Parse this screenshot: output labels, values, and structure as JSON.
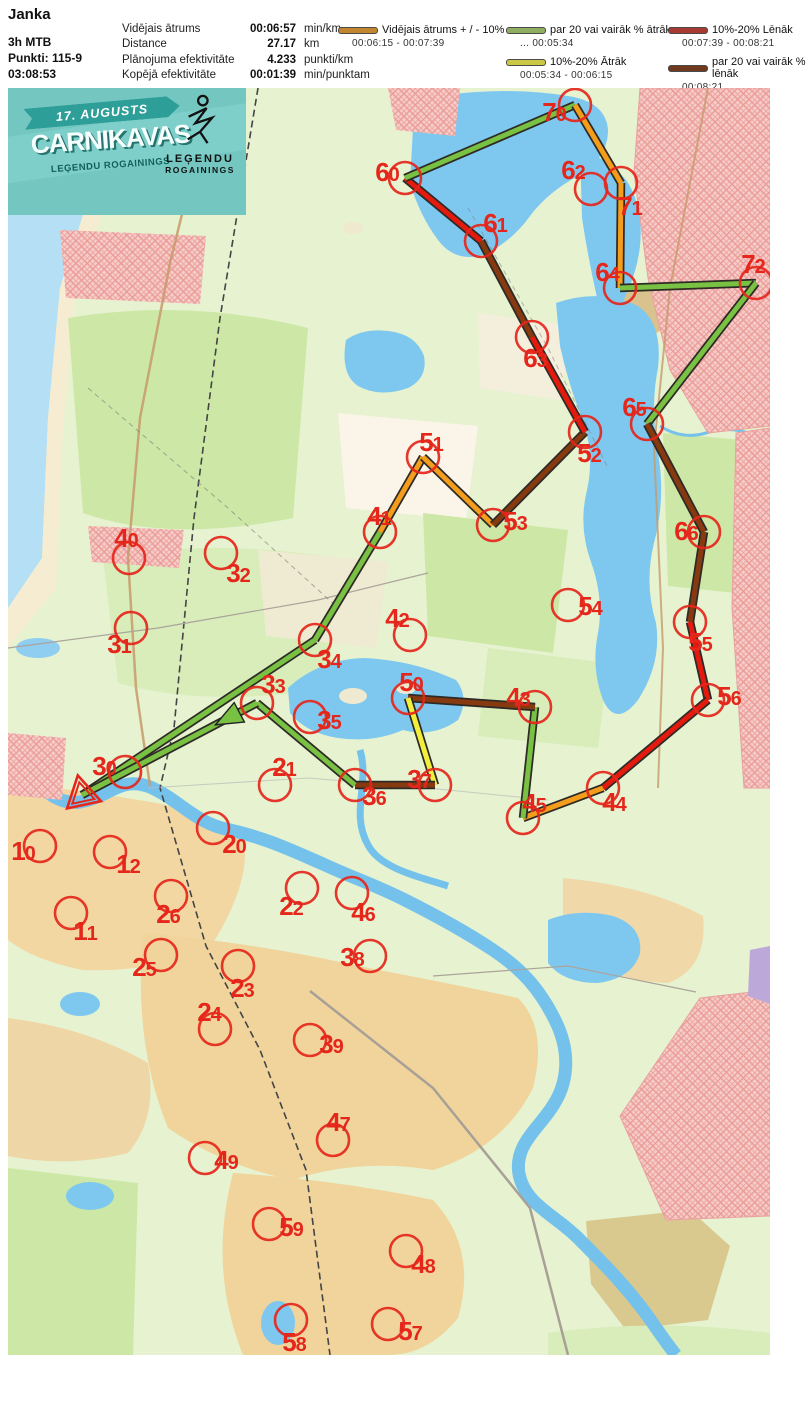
{
  "header": {
    "title": "Janka",
    "class_name": "3h MTB",
    "points": "Punkti: 115-9",
    "total_time": "03:08:53",
    "stats": [
      {
        "label": "Vidējais ātrums",
        "value": "00:06:57",
        "unit": "min/km"
      },
      {
        "label": "Distance",
        "value": "27.17",
        "unit": "km"
      },
      {
        "label": "Plānojuma efektivitāte",
        "value": "4.233",
        "unit": "punkti/km"
      },
      {
        "label": "Kopējā efektivitāte",
        "value": "00:01:39",
        "unit": "min/punktam"
      }
    ]
  },
  "legend": {
    "items": [
      {
        "col": 1,
        "color": "#c2862e",
        "label": "Vidējais ātrums + / - 10%",
        "range": "00:06:15   -   00:07:39"
      },
      {
        "col": 2,
        "color": "#8fae62",
        "label": "par 20 vai vairāk % ātrāk",
        "range": "...   00:05:34"
      },
      {
        "col": 2,
        "color": "#cbc943",
        "label": "10%-20% Ātrāk",
        "range": "00:05:34   -   00:06:15"
      },
      {
        "col": 3,
        "color": "#a93a31",
        "label": "10%-20% Lēnāk",
        "range": "00:07:39   -   00:08:21"
      },
      {
        "col": 3,
        "color": "#71391d",
        "label": "par 20 vai vairāk % lēnāk",
        "range": "00:08:21   ..."
      }
    ]
  },
  "banner": {
    "date": "17. AUGUSTS",
    "title": "CARNIKAVAS",
    "subtitle": "LEĢENDU ROGAININGS",
    "logo_line1": "LEĢENDU",
    "logo_line2": "ROGAININGS"
  },
  "map": {
    "control_color": "#e5261b",
    "route_outline": "#2e2a26",
    "route_colors": {
      "fast20": "#79c143",
      "fast10": "#f2ee3c",
      "average": "#f49d1c",
      "slow10": "#e41a0f",
      "slow20": "#87390f"
    },
    "start": {
      "x": 82,
      "y": 795
    },
    "controls": [
      {
        "id": "10",
        "x": 40,
        "y": 846,
        "lx": 23,
        "ly": 851
      },
      {
        "id": "11",
        "x": 71,
        "y": 913,
        "lx": 85,
        "ly": 931
      },
      {
        "id": "12",
        "x": 110,
        "y": 852,
        "lx": 128,
        "ly": 864
      },
      {
        "id": "20",
        "x": 213,
        "y": 828,
        "lx": 234,
        "ly": 844
      },
      {
        "id": "21",
        "x": 275,
        "y": 785,
        "lx": 284,
        "ly": 767
      },
      {
        "id": "22",
        "x": 302,
        "y": 888,
        "lx": 291,
        "ly": 906
      },
      {
        "id": "23",
        "x": 238,
        "y": 966,
        "lx": 242,
        "ly": 988
      },
      {
        "id": "24",
        "x": 215,
        "y": 1029,
        "lx": 209,
        "ly": 1012
      },
      {
        "id": "25",
        "x": 161,
        "y": 955,
        "lx": 144,
        "ly": 967
      },
      {
        "id": "26",
        "x": 171,
        "y": 896,
        "lx": 168,
        "ly": 914
      },
      {
        "id": "30",
        "x": 125,
        "y": 772,
        "lx": 104,
        "ly": 766
      },
      {
        "id": "31",
        "x": 131,
        "y": 628,
        "lx": 119,
        "ly": 644
      },
      {
        "id": "32",
        "x": 221,
        "y": 553,
        "lx": 238,
        "ly": 573
      },
      {
        "id": "33",
        "x": 257,
        "y": 703,
        "lx": 273,
        "ly": 684
      },
      {
        "id": "34",
        "x": 315,
        "y": 640,
        "lx": 329,
        "ly": 659
      },
      {
        "id": "35",
        "x": 310,
        "y": 717,
        "lx": 329,
        "ly": 720
      },
      {
        "id": "36",
        "x": 355,
        "y": 785,
        "lx": 374,
        "ly": 796
      },
      {
        "id": "37",
        "x": 435,
        "y": 785,
        "lx": 419,
        "ly": 779
      },
      {
        "id": "38",
        "x": 370,
        "y": 956,
        "lx": 352,
        "ly": 957
      },
      {
        "id": "39",
        "x": 310,
        "y": 1040,
        "lx": 331,
        "ly": 1044
      },
      {
        "id": "40",
        "x": 129,
        "y": 558,
        "lx": 126,
        "ly": 538
      },
      {
        "id": "41",
        "x": 380,
        "y": 532,
        "lx": 379,
        "ly": 516
      },
      {
        "id": "42",
        "x": 410,
        "y": 635,
        "lx": 397,
        "ly": 618
      },
      {
        "id": "43",
        "x": 535,
        "y": 707,
        "lx": 518,
        "ly": 697
      },
      {
        "id": "44",
        "x": 603,
        "y": 788,
        "lx": 614,
        "ly": 802
      },
      {
        "id": "45",
        "x": 523,
        "y": 818,
        "lx": 534,
        "ly": 803
      },
      {
        "id": "46",
        "x": 352,
        "y": 893,
        "lx": 363,
        "ly": 912
      },
      {
        "id": "47",
        "x": 333,
        "y": 1140,
        "lx": 338,
        "ly": 1122
      },
      {
        "id": "48",
        "x": 406,
        "y": 1251,
        "lx": 423,
        "ly": 1264
      },
      {
        "id": "49",
        "x": 205,
        "y": 1158,
        "lx": 226,
        "ly": 1160
      },
      {
        "id": "50",
        "x": 408,
        "y": 698,
        "lx": 411,
        "ly": 682
      },
      {
        "id": "51",
        "x": 423,
        "y": 457,
        "lx": 431,
        "ly": 442
      },
      {
        "id": "52",
        "x": 585,
        "y": 432,
        "lx": 589,
        "ly": 453
      },
      {
        "id": "53",
        "x": 493,
        "y": 525,
        "lx": 515,
        "ly": 521
      },
      {
        "id": "54",
        "x": 568,
        "y": 605,
        "lx": 590,
        "ly": 606
      },
      {
        "id": "55",
        "x": 690,
        "y": 622,
        "lx": 700,
        "ly": 642
      },
      {
        "id": "56",
        "x": 708,
        "y": 700,
        "lx": 729,
        "ly": 696
      },
      {
        "id": "57",
        "x": 388,
        "y": 1324,
        "lx": 410,
        "ly": 1331
      },
      {
        "id": "58",
        "x": 291,
        "y": 1320,
        "lx": 294,
        "ly": 1342
      },
      {
        "id": "59",
        "x": 269,
        "y": 1224,
        "lx": 291,
        "ly": 1227
      },
      {
        "id": "60",
        "x": 405,
        "y": 178,
        "lx": 387,
        "ly": 172
      },
      {
        "id": "61",
        "x": 481,
        "y": 241,
        "lx": 495,
        "ly": 223
      },
      {
        "id": "62",
        "x": 591,
        "y": 189,
        "lx": 573,
        "ly": 170
      },
      {
        "id": "63",
        "x": 532,
        "y": 337,
        "lx": 535,
        "ly": 358
      },
      {
        "id": "64",
        "x": 620,
        "y": 288,
        "lx": 607,
        "ly": 272
      },
      {
        "id": "65",
        "x": 647,
        "y": 424,
        "lx": 634,
        "ly": 407
      },
      {
        "id": "66",
        "x": 704,
        "y": 532,
        "lx": 686,
        "ly": 531
      },
      {
        "id": "70",
        "x": 575,
        "y": 105,
        "lx": 554,
        "ly": 112
      },
      {
        "id": "71",
        "x": 621,
        "y": 183,
        "lx": 630,
        "ly": 206
      },
      {
        "id": "72",
        "x": 756,
        "y": 283,
        "lx": 753,
        "ly": 264
      }
    ],
    "route": [
      {
        "from": "start",
        "to": "34",
        "cat": "fast20"
      },
      {
        "from": "34",
        "to": "41",
        "cat": "fast20"
      },
      {
        "from": "41",
        "to": "51",
        "cat": "average"
      },
      {
        "from": "51",
        "to": "53",
        "cat": "average"
      },
      {
        "from": "53",
        "to": "52",
        "cat": "slow20"
      },
      {
        "from": "52",
        "to": "63",
        "cat": "slow10"
      },
      {
        "from": "63",
        "to": "61",
        "cat": "slow20"
      },
      {
        "from": "61",
        "to": "60",
        "cat": "slow10"
      },
      {
        "from": "60",
        "to": "70",
        "cat": "fast20"
      },
      {
        "from": "70",
        "to": "71",
        "cat": "average"
      },
      {
        "from": "71",
        "to": "64",
        "cat": "average"
      },
      {
        "from": "64",
        "to": "72",
        "cat": "fast20"
      },
      {
        "from": "72",
        "to": "65",
        "cat": "fast20"
      },
      {
        "from": "65",
        "to": "66",
        "cat": "slow20"
      },
      {
        "from": "66",
        "to": "55",
        "cat": "slow20"
      },
      {
        "from": "55",
        "to": "56",
        "cat": "slow10"
      },
      {
        "from": "56",
        "to": "44",
        "cat": "slow10"
      },
      {
        "from": "44",
        "to": "45",
        "cat": "average"
      },
      {
        "from": "45",
        "to": "43",
        "cat": "fast20"
      },
      {
        "from": "43",
        "to": "50",
        "cat": "slow20"
      },
      {
        "from": "50",
        "to": "37",
        "cat": "fast10"
      },
      {
        "from": "37",
        "to": "36",
        "cat": "slow20"
      },
      {
        "from": "36",
        "to": "33",
        "cat": "fast20"
      },
      {
        "from": "33",
        "to": "finish",
        "cat": "fast20",
        "arrow": true
      }
    ]
  }
}
